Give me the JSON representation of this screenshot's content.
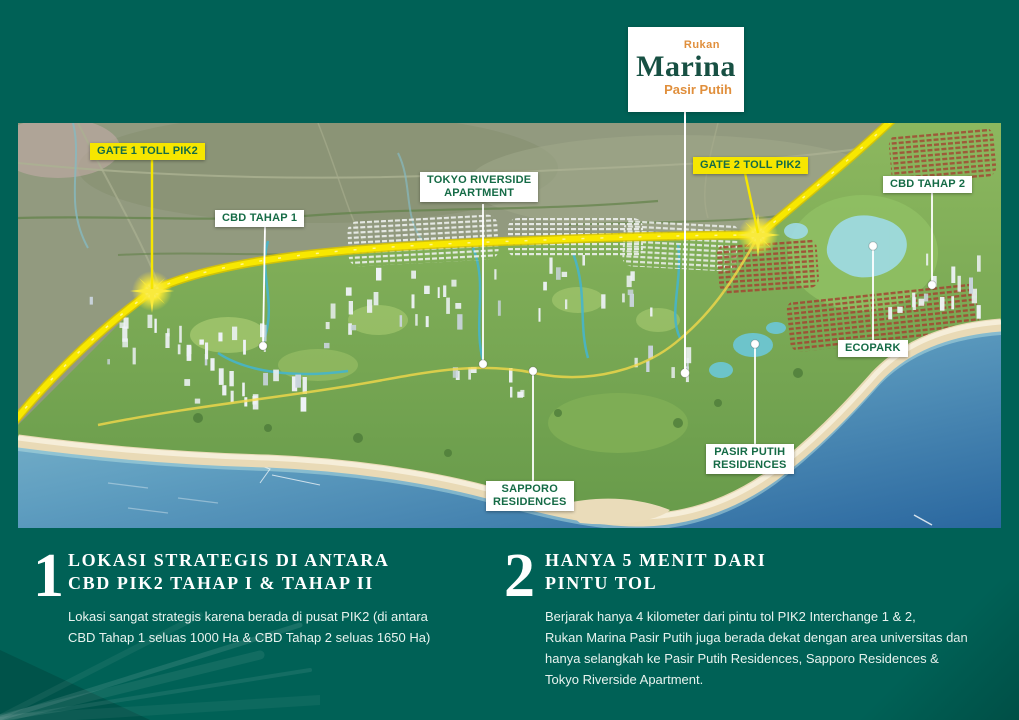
{
  "logo": {
    "line1": "Rukan",
    "line2": "Marina",
    "line3": "Pasir Putih"
  },
  "map": {
    "labels": [
      {
        "id": "gate1-toll-pik2",
        "text": "GATE 1 TOLL PIK2",
        "style": "yellow"
      },
      {
        "id": "cbd-tahap-1",
        "text": "CBD TAHAP 1",
        "style": "white"
      },
      {
        "id": "tokyo-riverside-apartment",
        "text": "TOKYO RIVERSIDE\nAPARTMENT",
        "style": "white"
      },
      {
        "id": "gate2-toll-pik2",
        "text": "GATE 2 TOLL PIK2",
        "style": "yellow"
      },
      {
        "id": "cbd-tahap-2",
        "text": "CBD TAHAP 2",
        "style": "white"
      },
      {
        "id": "ecopark",
        "text": "ECOPARK",
        "style": "white"
      },
      {
        "id": "pasir-putih-residences",
        "text": "PASIR PUTIH\nRESIDENCES",
        "style": "white"
      },
      {
        "id": "sapporo-residences",
        "text": "SAPPORO\nRESIDENCES",
        "style": "white"
      }
    ],
    "colors": {
      "background_teal": "#006156",
      "label_text_green": "#156b46",
      "highlight_yellow": "#f6e600",
      "logo_orange": "#e08f3c",
      "logo_green": "#175043"
    }
  },
  "sections": [
    {
      "number": "1",
      "title": "LOKASI STRATEGIS DI ANTARA\nCBD PIK2 TAHAP I & TAHAP II",
      "body": "Lokasi sangat strategis karena berada di pusat PIK2 (di antara\nCBD Tahap 1 seluas 1000 Ha & CBD Tahap 2 seluas 1650 Ha)"
    },
    {
      "number": "2",
      "title": "HANYA 5 MENIT  DARI\nPINTU TOL",
      "body": "Berjarak hanya 4 kilometer dari pintu tol PIK2 Interchange 1 & 2,\nRukan Marina Pasir Putih juga berada dekat dengan area universitas dan\nhanya selangkah ke Pasir Putih Residences, Sapporo Residences &\nTokyo Riverside Apartment."
    }
  ]
}
